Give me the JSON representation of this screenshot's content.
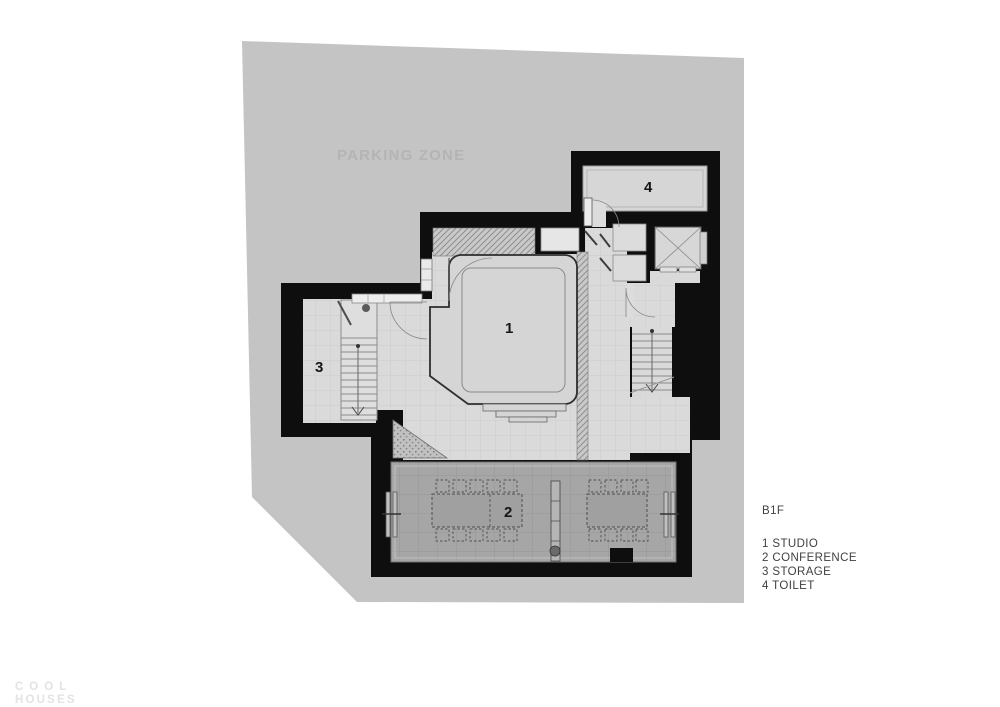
{
  "site": {
    "label": "PARKING ZONE",
    "color": "#c4c4c4",
    "label_color": "#b4b4b4"
  },
  "floor": {
    "title": "B1F"
  },
  "rooms": [
    {
      "number": "1",
      "name": "STUDIO"
    },
    {
      "number": "2",
      "name": "CONFERENCE"
    },
    {
      "number": "3",
      "name": "STORAGE"
    },
    {
      "number": "4",
      "name": "TOILET"
    }
  ],
  "legend": {
    "items": [
      "1 STUDIO",
      "2 CONFERENCE",
      "3 STORAGE",
      "4 TOILET"
    ],
    "text_color": "#3f3f3f"
  },
  "watermark": {
    "line1": "COOL",
    "line2": "HOUSES",
    "color": "#e3e3e3"
  },
  "colors": {
    "wall": "#0e0e0e",
    "floor_light": "#dadada",
    "floor_conference": "#a6a6a6",
    "floor_room": "#d6d6d6"
  }
}
